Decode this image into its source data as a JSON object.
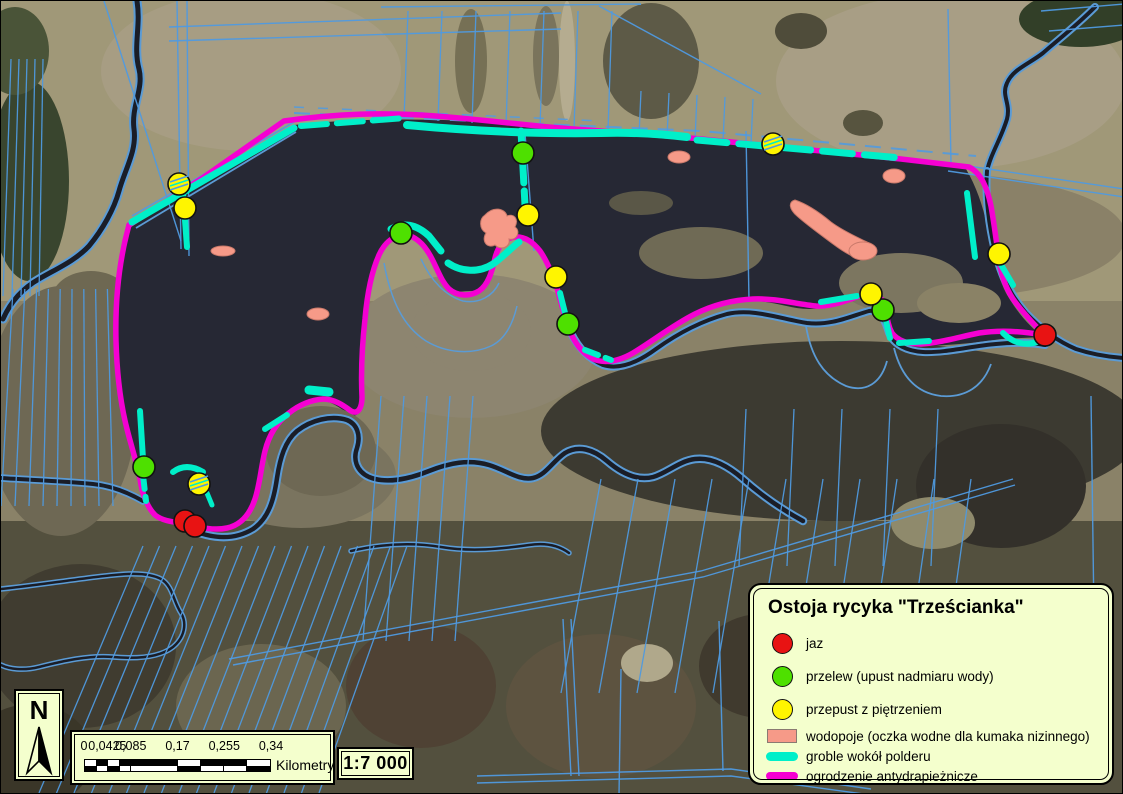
{
  "north_label": "N",
  "scale": {
    "ratio_label": "1:7 000",
    "unit_label": "Kilometry",
    "tick_labels": [
      "0",
      "0,0425",
      "0,085",
      "0,17",
      "0,255",
      "0,34"
    ],
    "tick_fracs": [
      0,
      0.125,
      0.25,
      0.5,
      0.75,
      1
    ],
    "bar_fracs": [
      0,
      0.0625,
      0.125,
      0.1875,
      0.25,
      0.5,
      0.625,
      0.75,
      0.875,
      1
    ],
    "top_row_colors": [
      "W",
      "B",
      "W",
      "B",
      "B",
      "W",
      "B",
      "B",
      "W"
    ],
    "bar_black": "#000000",
    "bar_white": "#ffffff"
  },
  "legend": {
    "title": "Ostoja rycyka \"Trześcianka\"",
    "items": [
      {
        "label": "jaz",
        "swatch": "circle",
        "color": "#e81313"
      },
      {
        "label": "przelew (upust nadmiaru wody)",
        "swatch": "circle",
        "color": "#4ee000"
      },
      {
        "label": "przepust z piętrzeniem",
        "swatch": "circle",
        "color": "#fff500"
      },
      {
        "label": "wodopoje (oczka wodne dla kumaka nizinnego)",
        "swatch": "rect",
        "color": "#f69a88"
      },
      {
        "label": "groble wokół polderu",
        "swatch": "line",
        "color": "#00efc9"
      },
      {
        "label": "ogrodzenie antydrapieżnicze",
        "swatch": "line",
        "color": "#f500d2"
      }
    ]
  },
  "colors": {
    "box_bg": "#f4ffcd",
    "fence": "#f500d2",
    "dike": "#00efc9",
    "parcel": "#4f9ae0",
    "river_case": "#5b9bd5",
    "river": "#1a1d27",
    "pond": "#f69a88",
    "pond_edge": "#c9796a",
    "red": "#e81313",
    "green": "#4ee000",
    "yellow": "#fff500",
    "point_stroke": "#111111",
    "polder": "#262834"
  },
  "map_features": {
    "terrain": [
      {
        "t": "rect",
        "x": 0,
        "y": 0,
        "w": 1123,
        "h": 300,
        "f": "#a09878"
      },
      {
        "t": "rect",
        "x": 0,
        "y": 520,
        "w": 1123,
        "h": 274,
        "f": "#53503e"
      },
      {
        "t": "rect",
        "x": 0,
        "y": 300,
        "w": 1123,
        "h": 220,
        "f": "#8a8268"
      },
      {
        "t": "e",
        "cx": 250,
        "cy": 70,
        "rx": 150,
        "ry": 80,
        "f": "#a79d83"
      },
      {
        "t": "e",
        "cx": 28,
        "cy": 180,
        "rx": 40,
        "ry": 100,
        "f": "#39452e"
      },
      {
        "t": "e",
        "cx": 14,
        "cy": 50,
        "rx": 34,
        "ry": 44,
        "f": "#4a5438"
      },
      {
        "t": "e",
        "cx": 90,
        "cy": 300,
        "rx": 40,
        "ry": 30,
        "f": "#6e6852"
      },
      {
        "t": "e",
        "cx": 60,
        "cy": 410,
        "rx": 75,
        "ry": 125,
        "f": "#6e6854"
      },
      {
        "t": "e",
        "cx": 470,
        "cy": 60,
        "rx": 16,
        "ry": 52,
        "f": "#767055"
      },
      {
        "t": "e",
        "cx": 545,
        "cy": 55,
        "rx": 13,
        "ry": 50,
        "f": "#7a745c"
      },
      {
        "t": "e",
        "cx": 566,
        "cy": 60,
        "rx": 8,
        "ry": 60,
        "f": "#b5ac90"
      },
      {
        "t": "e",
        "cx": 650,
        "cy": 60,
        "rx": 48,
        "ry": 58,
        "f": "#5d5a47"
      },
      {
        "t": "e",
        "cx": 950,
        "cy": 80,
        "rx": 175,
        "ry": 88,
        "f": "#a89e85"
      },
      {
        "t": "e",
        "cx": 1080,
        "cy": 18,
        "rx": 62,
        "ry": 28,
        "f": "#323f28"
      },
      {
        "t": "e",
        "cx": 800,
        "cy": 30,
        "rx": 26,
        "ry": 18,
        "f": "#4f4c3a"
      },
      {
        "t": "e",
        "cx": 862,
        "cy": 122,
        "rx": 20,
        "ry": 13,
        "f": "#57543f"
      },
      {
        "t": "e",
        "cx": 940,
        "cy": 235,
        "rx": 185,
        "ry": 62,
        "f": "#8a8168"
      },
      {
        "t": "e",
        "cx": 855,
        "cy": 242,
        "rx": 58,
        "ry": 28,
        "f": "#454233"
      },
      {
        "t": "e",
        "cx": 840,
        "cy": 430,
        "rx": 300,
        "ry": 90,
        "f": "#3c3a31"
      },
      {
        "t": "e",
        "cx": 470,
        "cy": 345,
        "rx": 125,
        "ry": 72,
        "f": "#8d8570"
      },
      {
        "t": "e",
        "cx": 300,
        "cy": 475,
        "rx": 95,
        "ry": 52,
        "f": "#7a745f"
      },
      {
        "t": "e",
        "cx": 80,
        "cy": 645,
        "rx": 95,
        "ry": 82,
        "f": "#403c30"
      },
      {
        "t": "e",
        "cx": 260,
        "cy": 705,
        "rx": 85,
        "ry": 62,
        "f": "#6b6650"
      },
      {
        "t": "e",
        "cx": 420,
        "cy": 685,
        "rx": 75,
        "ry": 62,
        "f": "#4f4234"
      },
      {
        "t": "e",
        "cx": 600,
        "cy": 705,
        "rx": 95,
        "ry": 72,
        "f": "#5d5340"
      },
      {
        "t": "e",
        "cx": 760,
        "cy": 665,
        "rx": 62,
        "ry": 52,
        "f": "#403a2e"
      },
      {
        "t": "e",
        "cx": 950,
        "cy": 705,
        "rx": 105,
        "ry": 72,
        "f": "#37342b"
      },
      {
        "t": "e",
        "cx": 646,
        "cy": 662,
        "rx": 26,
        "ry": 19,
        "f": "#b0a88b"
      },
      {
        "t": "e",
        "cx": 1000,
        "cy": 485,
        "rx": 85,
        "ry": 62,
        "f": "#33302a"
      },
      {
        "t": "e",
        "cx": 932,
        "cy": 522,
        "rx": 42,
        "ry": 26,
        "f": "#8f8a6c"
      },
      {
        "t": "e",
        "cx": 1060,
        "cy": 625,
        "rx": 52,
        "ry": 42,
        "f": "#6b6550"
      },
      {
        "t": "e",
        "cx": 30,
        "cy": 755,
        "rx": 62,
        "ry": 52,
        "f": "#3a3628"
      }
    ],
    "polder": {
      "d": "M130,226 L293,124 C 400,112 520,122 620,130 C 720,138 850,150 965,168 C 975,185 982,205 986,225 C 990,248 995,272 1005,292 C 1018,315 1032,328 1042,336 L1000,338 C 975,342 950,344 928,345 C 908,345 896,341 890,330 C 886,320 886,310 882,303 C 876,295 866,296 856,298 C 840,302 824,308 808,308 C 790,308 772,300 752,300 C 728,300 706,307 688,317 C 668,328 648,344 630,355 C 616,363 602,366 590,360 C 578,354 570,342 565,328 C 560,312 557,298 553,284 C 549,270 544,258 537,250 C 529,241 520,237 511,238 C 501,240 496,248 493,260 C 490,272 487,284 478,292 C 468,299 455,297 446,289 C 438,281 434,268 428,257 C 421,244 412,236 402,236 C 391,236 383,244 377,257 C 371,271 367,290 365,315 C 363,345 362,375 362,398 C 362,410 356,418 348,413 C 339,407 330,400 321,400 C 309,400 297,406 287,414 C 276,423 269,436 265,452 C 261,468 259,485 254,500 C 249,514 240,525 227,529 C 213,532 198,528 186,525 C 174,522 162,522 153,515 C 144,507 140,493 138,478 C 135,462 130,448 125,430 C 119,407 115,376 114,340 C 113,302 117,262 130,226 Z"
    },
    "islands": [
      {
        "t": "e",
        "cx": 700,
        "cy": 252,
        "rx": 62,
        "ry": 26,
        "f": "#6f6a55"
      },
      {
        "t": "e",
        "cx": 900,
        "cy": 282,
        "rx": 62,
        "ry": 30,
        "f": "#7c7660"
      },
      {
        "t": "e",
        "cx": 958,
        "cy": 302,
        "rx": 42,
        "ry": 20,
        "f": "#8a8266"
      },
      {
        "t": "e",
        "cx": 640,
        "cy": 202,
        "rx": 32,
        "ry": 12,
        "f": "#5a5747"
      },
      {
        "t": "e",
        "cx": 470,
        "cy": 330,
        "rx": 60,
        "ry": 40,
        "f": "#8d8570"
      },
      {
        "t": "e",
        "cx": 320,
        "cy": 450,
        "rx": 55,
        "ry": 45,
        "f": "#6e6854"
      }
    ],
    "rivers": [
      {
        "d": "M136,0 C 140,25 132,45 138,68 C 143,88 130,105 133,128 C 136,150 124,168 118,190 C 113,208 102,228 88,245 C 74,260 55,268 38,278 C 22,287 10,300 2,318",
        "w": 5,
        "cw": 9
      },
      {
        "d": "M1094,6 C 1075,25 1058,38 1042,52 C 1028,63 1012,68 1006,82 C 1000,95 1010,102 1006,118 C 1000,138 990,152 986,170",
        "w": 4,
        "cw": 8
      },
      {
        "d": "M986,170 C 984,195 988,225 994,250 C 1000,275 1010,295 1025,312 C 1040,328 1056,340 1075,348 C 1090,353 1108,356 1123,357",
        "w": 4,
        "cw": 8
      },
      {
        "d": "M570,332 C 578,348 588,358 602,364 C 618,369 636,362 655,348 C 676,333 700,320 726,313 C 752,307 780,318 806,322 C 830,325 850,315 868,310 C 878,308 884,318 888,332 C 893,344 906,350 922,351 C 945,352 970,345 995,343 C 1015,341 1032,342 1044,344",
        "w": 4,
        "cw": 8
      },
      {
        "d": "M186,527 C 210,538 232,540 252,528 C 268,517 273,498 276,477 C 279,457 284,440 296,430 C 310,419 330,414 346,419 C 356,423 360,434 356,447 C 352,458 355,470 368,476 C 385,483 408,478 428,470 C 448,462 468,458 488,464 C 505,469 518,480 532,477 C 545,474 552,460 564,452 C 577,444 592,448 606,460 C 620,472 636,480 652,476 C 666,472 678,460 694,458 C 710,456 726,464 742,478 C 760,494 780,508 802,520",
        "w": 4.5,
        "cw": 8.5
      },
      {
        "d": "M0,477 C 30,479 62,480 92,483 C 112,485 128,492 142,500",
        "w": 4,
        "cw": 7.5
      },
      {
        "d": "M0,588 C 30,585 62,580 95,576 C 120,573 145,570 160,578 C 172,585 172,600 180,612 C 186,622 184,636 172,646 C 158,657 135,658 112,656 C 88,654 62,660 38,666 C 22,670 8,668 0,664",
        "w": 2.5,
        "cw": 5.5
      },
      {
        "d": "M350,550 C 380,543 410,541 440,546 C 470,551 500,548 528,544 C 548,541 560,546 568,552",
        "w": 2.5,
        "cw": 5.5
      }
    ],
    "thin_blue": [
      {
        "d": "M383,262 C 390,300 402,325 425,340 C 445,352 470,354 490,345 C 505,338 512,322 516,305",
        "w": 1.5
      },
      {
        "d": "M420,258 C 430,280 445,295 462,300 C 478,303 492,295 498,282",
        "w": 1.5
      },
      {
        "d": "M805,325 C 810,355 822,375 845,385 C 865,392 880,382 886,360",
        "w": 1.8
      },
      {
        "d": "M893,347 C 900,375 915,392 940,395 C 965,397 982,385 990,363",
        "w": 1.8
      },
      {
        "d": "M128,228 C 118,262 113,300 115,340 C 116,375 121,408 128,432",
        "w": 1.5
      },
      {
        "d": "M131,215 L293,121",
        "w": 1.8
      },
      {
        "d": "M135,227 L295,131",
        "w": 1.8
      },
      {
        "d": "M293,112 L700,130 L975,155",
        "w": 2,
        "dash": "16 10"
      },
      {
        "d": "M293,106 L600,120",
        "w": 1.5,
        "dash": "10 14"
      }
    ],
    "parcel_bundles": [
      {
        "x1": 10,
        "y1": 58,
        "x2": 2,
        "y2": 295,
        "n": 5,
        "dx1": 8,
        "dy1": 0,
        "dx2": 9,
        "dy2": 0
      },
      {
        "x1": 12,
        "y1": 288,
        "x2": 0,
        "y2": 505,
        "n": 9,
        "dx1": 11.8,
        "dy1": 0,
        "dx2": 14,
        "dy2": 0
      },
      {
        "x1": 407,
        "y1": 10,
        "x2": 403,
        "y2": 118,
        "n": 7,
        "dx1": 34,
        "dy1": 0,
        "dx2": 34,
        "dy2": 2
      },
      {
        "x1": 640,
        "y1": 90,
        "x2": 638,
        "y2": 135,
        "n": 5,
        "dx1": 28,
        "dy1": 2,
        "dx2": 28,
        "dy2": 2
      },
      {
        "x1": 380,
        "y1": 395,
        "x2": 362,
        "y2": 640,
        "n": 5,
        "dx1": 23,
        "dy1": 0,
        "dx2": 23,
        "dy2": 0
      },
      {
        "x1": 745,
        "y1": 408,
        "x2": 738,
        "y2": 565,
        "n": 5,
        "dx1": 48,
        "dy1": 0,
        "dx2": 48,
        "dy2": 0
      },
      {
        "x1": 142,
        "y1": 545,
        "x2": 38,
        "y2": 792,
        "n": 17,
        "dx1": 16.5,
        "dy1": 0,
        "dx2": 17.5,
        "dy2": 0
      },
      {
        "x1": 600,
        "y1": 478,
        "x2": 560,
        "y2": 692,
        "n": 11,
        "dx1": 37,
        "dy1": 0,
        "dx2": 38,
        "dy2": 0
      }
    ],
    "parcel_lines": [
      {
        "d": "M176,0 L180,248"
      },
      {
        "d": "M186,0 L188,255"
      },
      {
        "d": "M103,0 L180,240"
      },
      {
        "d": "M168,26 L560,12"
      },
      {
        "d": "M168,40 L560,28"
      },
      {
        "d": "M380,6 L640,3"
      },
      {
        "d": "M598,5 L760,93"
      },
      {
        "d": "M947,8 L950,162"
      },
      {
        "d": "M947,162 L1123,188"
      },
      {
        "d": "M947,170 L1123,196"
      },
      {
        "d": "M1040,10 L1123,3"
      },
      {
        "d": "M1048,30 L1123,24"
      },
      {
        "d": "M745,130 L748,300"
      },
      {
        "d": "M524,132 L533,250"
      },
      {
        "d": "M1090,395 L1094,690"
      },
      {
        "d": "M562,618 L570,775"
      },
      {
        "d": "M570,618 L578,775"
      },
      {
        "d": "M620,668 L618,794"
      },
      {
        "d": "M718,620 L722,770"
      },
      {
        "d": "M228,658 L700,570 L1012,478"
      },
      {
        "d": "M232,664 L702,576 L1014,484"
      },
      {
        "d": "M476,775 L730,768 L870,788"
      },
      {
        "d": "M476,782 L730,775 L870,794"
      }
    ],
    "fence": [
      {
        "d": "M128,224 L200,178 283,120 C 340,112 380,112 420,114 C 470,117 520,124 560,127 C 610,131 660,134 700,138 C 760,144 820,150 900,158 L968,166 C 980,172 986,186 990,205 C 993,222 995,238 997,252 C 999,270 1004,286 1012,298 C 1022,312 1034,324 1042,333"
      },
      {
        "d": "M128,224 C 118,260 114,300 115,340 C 116,375 120,405 126,428 C 131,448 136,462 139,478 C 141,492 146,506 154,514 C 163,521 175,521 186,523 C 198,526 212,530 226,527 C 240,524 249,513 254,498 C 259,483 260,466 264,450 C 268,434 276,421 288,412 C 298,404 310,399 322,398 C 333,398 342,404 350,410 C 357,414 361,407 361,396 C 360,375 361,345 364,318 C 366,295 370,272 378,254 C 384,241 393,234 404,234 C 414,235 423,243 430,256 C 436,267 440,280 448,288 C 456,295 468,296 478,290 C 487,284 491,271 494,257 C 497,245 503,238 513,236 C 523,235 532,241 539,250 C 546,260 551,272 556,287 C 560,301 563,315 568,328 C 573,341 581,352 592,358 C 604,363 618,360 632,352 C 652,340 672,324 694,313 C 712,304 731,299 752,298 C 775,297 795,303 815,305 C 832,306 848,298 862,294 C 872,291 880,295 884,304 C 886,313 886,323 891,332 C 897,340 908,343 920,343 C 938,342 958,336 978,332 C 998,329 1020,330 1042,334"
      }
    ],
    "dikes": [
      {
        "d": "M131,221 L293,127",
        "w": 7
      },
      {
        "d": "M300,125 L404,117",
        "w": 6,
        "dash": "26 10"
      },
      {
        "d": "M406,124 C 470,130 540,133 600,132 C 630,131 660,133 686,136",
        "w": 8
      },
      {
        "d": "M696,139 L900,157",
        "w": 7,
        "dash": "30 12"
      },
      {
        "d": "M966,192 L974,256",
        "w": 6
      },
      {
        "d": "M520,130 L524,204",
        "w": 7,
        "dash": "22 8"
      },
      {
        "d": "M182,192 L186,246",
        "w": 6
      },
      {
        "d": "M139,410 L142,458",
        "w": 6
      },
      {
        "d": "M142,474 L145,500",
        "w": 6,
        "dash": "14 8"
      },
      {
        "d": "M172,471 C 180,465 190,464 202,471",
        "w": 6
      },
      {
        "d": "M206,492 L211,504",
        "w": 5
      },
      {
        "d": "M390,228 C 402,221 415,223 428,235 L440,250",
        "w": 7
      },
      {
        "d": "M447,262 C 460,271 478,272 492,263 C 502,256 510,247 518,241",
        "w": 7
      },
      {
        "d": "M559,292 L564,312",
        "w": 6
      },
      {
        "d": "M584,349 L610,359",
        "w": 6,
        "dash": "14 8"
      },
      {
        "d": "M264,428 L286,414",
        "w": 6
      },
      {
        "d": "M308,389 L328,391",
        "w": 9
      },
      {
        "d": "M820,301 L856,295",
        "w": 6
      },
      {
        "d": "M884,316 L889,337",
        "w": 6
      },
      {
        "d": "M898,342 L928,340",
        "w": 6
      },
      {
        "d": "M999,262 L1012,284",
        "w": 6
      },
      {
        "d": "M1002,332 C 1012,342 1024,345 1036,341",
        "w": 6
      }
    ],
    "ponds": [
      {
        "t": "e",
        "cx": 222,
        "cy": 250,
        "rx": 12,
        "ry": 5
      },
      {
        "t": "p",
        "d": "M484,214 C 492,205 504,207 506,215 C 513,212 518,218 514,226 C 520,230 516,240 508,238 C 510,246 500,250 494,244 C 486,248 480,240 485,232 C 478,228 478,218 484,214 Z"
      },
      {
        "t": "e",
        "cx": 678,
        "cy": 156,
        "rx": 11,
        "ry": 6
      },
      {
        "t": "e",
        "cx": 893,
        "cy": 175,
        "rx": 11,
        "ry": 7
      },
      {
        "t": "p",
        "d": "M794,199 C 806,203 818,211 830,221 C 842,230 856,236 866,241 C 876,245 878,254 870,257 C 858,261 844,252 832,243 C 820,234 806,224 796,215 C 788,208 787,201 794,199 Z"
      },
      {
        "t": "e",
        "cx": 862,
        "cy": 250,
        "rx": 14,
        "ry": 9
      },
      {
        "t": "e",
        "cx": 317,
        "cy": 313,
        "rx": 11,
        "ry": 6
      }
    ],
    "points": [
      {
        "x": 184,
        "y": 520,
        "c": "red"
      },
      {
        "x": 194,
        "y": 525,
        "c": "red"
      },
      {
        "x": 1044,
        "y": 334,
        "c": "red"
      },
      {
        "x": 522,
        "y": 152,
        "c": "green"
      },
      {
        "x": 400,
        "y": 232,
        "c": "green"
      },
      {
        "x": 567,
        "y": 323,
        "c": "green"
      },
      {
        "x": 882,
        "y": 309,
        "c": "green"
      },
      {
        "x": 143,
        "y": 466,
        "c": "green"
      },
      {
        "x": 178,
        "y": 183,
        "c": "yellow",
        "hatched": true
      },
      {
        "x": 184,
        "y": 207,
        "c": "yellow"
      },
      {
        "x": 527,
        "y": 214,
        "c": "yellow"
      },
      {
        "x": 555,
        "y": 276,
        "c": "yellow"
      },
      {
        "x": 772,
        "y": 143,
        "c": "yellow",
        "hatched": true
      },
      {
        "x": 870,
        "y": 293,
        "c": "yellow"
      },
      {
        "x": 998,
        "y": 253,
        "c": "yellow"
      },
      {
        "x": 198,
        "y": 483,
        "c": "yellow",
        "hatched": true
      }
    ]
  }
}
